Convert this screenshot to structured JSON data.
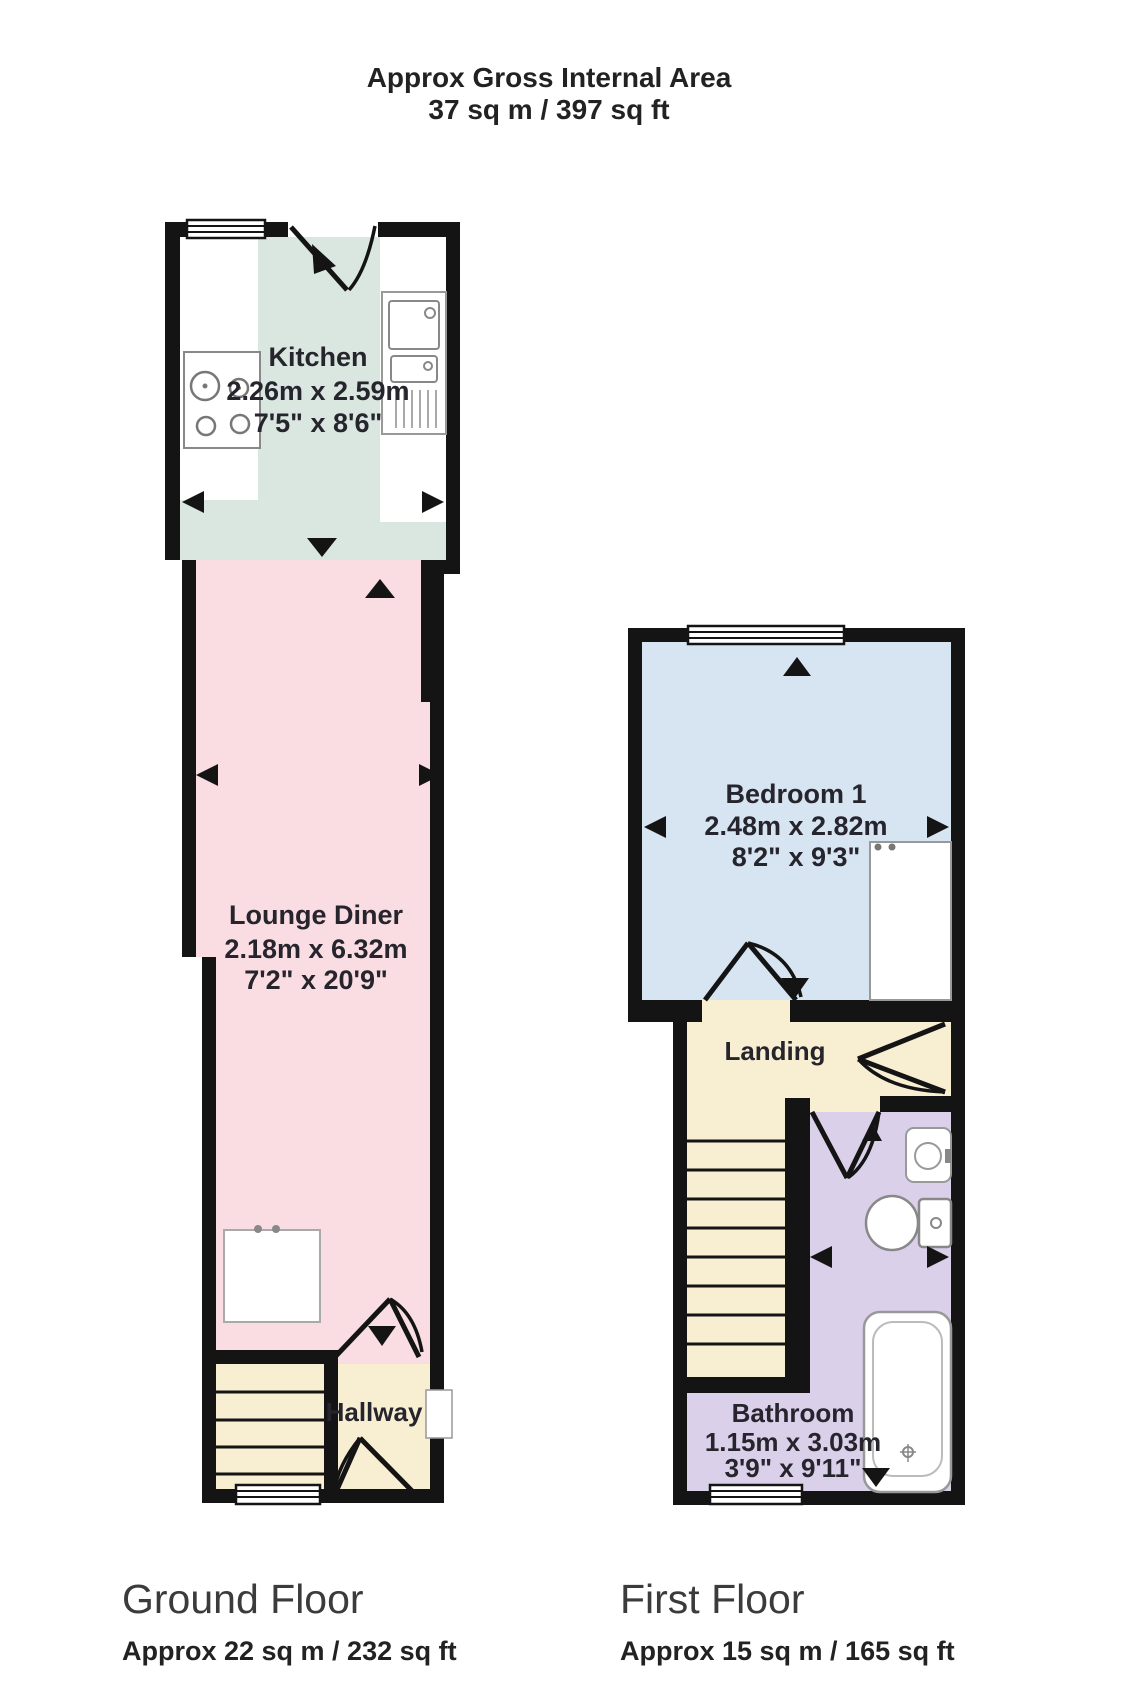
{
  "title": {
    "line1": "Approx Gross Internal Area",
    "line2": "37 sq m / 397 sq ft"
  },
  "floors": {
    "ground": {
      "label": "Ground Floor",
      "area": "Approx 22 sq m / 232 sq ft"
    },
    "first": {
      "label": "First Floor",
      "area": "Approx 15 sq m / 165 sq ft"
    }
  },
  "rooms": {
    "kitchen": {
      "name": "Kitchen",
      "metric": "2.26m x 2.59m",
      "imperial": "7'5\" x 8'6\""
    },
    "lounge_diner": {
      "name": "Lounge Diner",
      "metric": "2.18m x 6.32m",
      "imperial": "7'2\" x 20'9\""
    },
    "hallway": {
      "name": "Hallway"
    },
    "bedroom_1": {
      "name": "Bedroom 1",
      "metric": "2.48m x 2.82m",
      "imperial": "8'2\" x 9'3\""
    },
    "landing": {
      "name": "Landing"
    },
    "bathroom": {
      "name": "Bathroom",
      "metric": "1.15m x 3.03m",
      "imperial": "3'9\" x 9'11\""
    }
  },
  "colors": {
    "wall": "#141414",
    "kitchen_floor": "#d9e7e0",
    "lounge_floor": "#f9dde2",
    "hall_floor": "#f8efd2",
    "bedroom_floor": "#d7e5f2",
    "bathroom_floor": "#dbd0ea",
    "fixture_outline": "#999999",
    "text": "#26242c"
  }
}
